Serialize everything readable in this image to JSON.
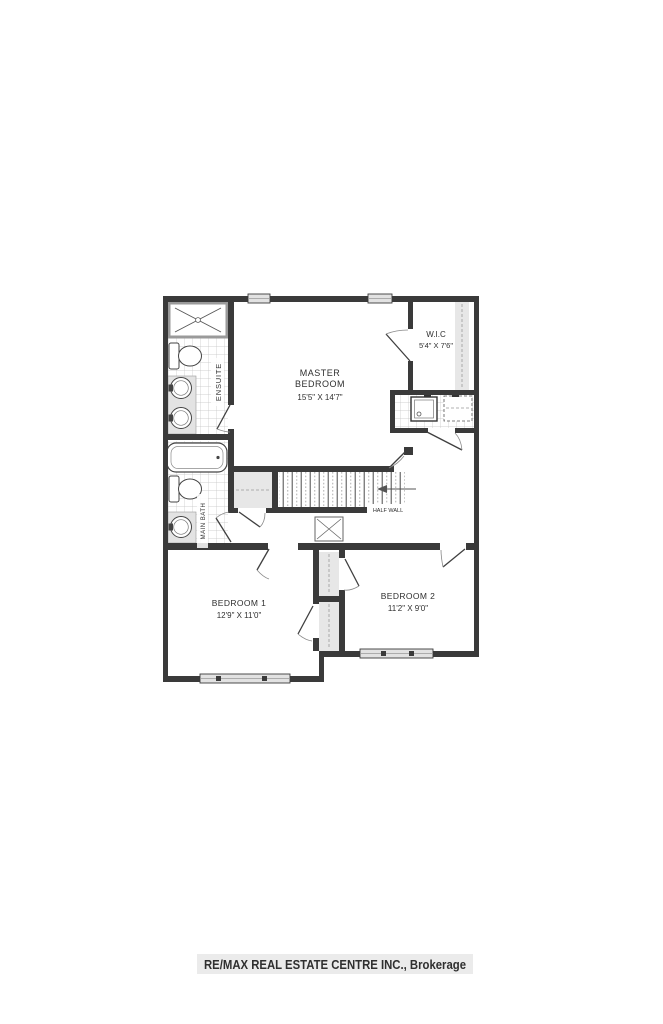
{
  "rooms": {
    "master": {
      "line1": "MASTER",
      "line2": "BEDROOM",
      "dims": "15'5\" X 14'7\""
    },
    "wic": {
      "name": "W.I.C",
      "dims": "5'4\" X 7'6\""
    },
    "ensuite": {
      "name": "ENSUITE"
    },
    "main_bath": {
      "name": "MAIN BATH"
    },
    "bedroom1": {
      "name": "BEDROOM 1",
      "dims": "12'9\" X 11'0\""
    },
    "bedroom2": {
      "name": "BEDROOM 2",
      "dims": "11'2\" X 9'0\""
    }
  },
  "annotations": {
    "half_wall": "HALF WALL"
  },
  "watermark": {
    "text": "RE/MAX REAL ESTATE CENTRE INC., Brokerage"
  },
  "fixtures": [
    "shower",
    "toilet",
    "double-sink-vanity",
    "bathtub",
    "sink-vanity",
    "washer",
    "dryer-counter",
    "linen-shelf",
    "closet-shelf",
    "stairs",
    "attic-access",
    "windows"
  ],
  "colors": {
    "wall": "#3a3a3a",
    "tile_line": "#c3c3c3",
    "gray_fill": "#e7e7e7",
    "watermark_bg": "#ebebeb",
    "watermark_text": "#ffffff"
  }
}
